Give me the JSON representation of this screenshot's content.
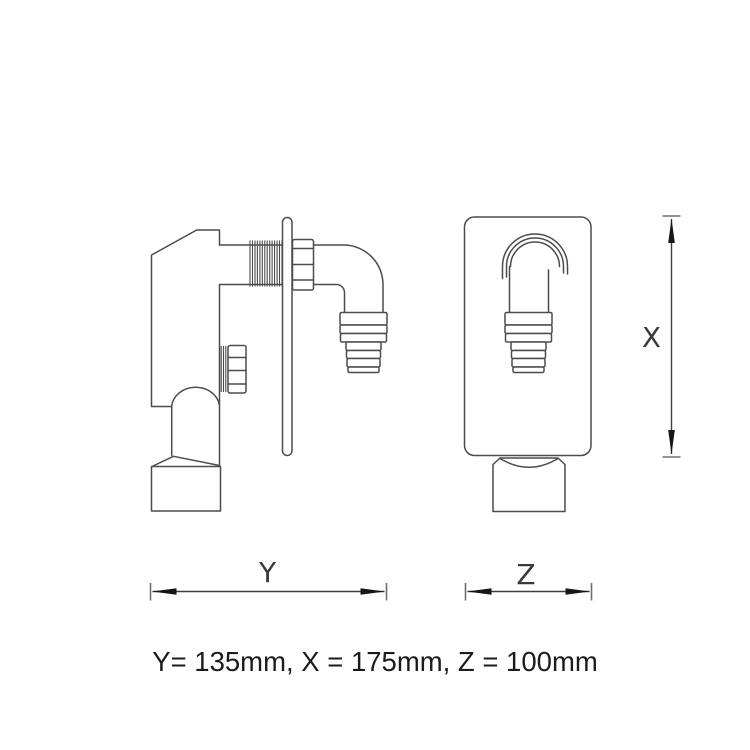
{
  "drawing": {
    "description": "two-view technical line drawing of a through-wall washing machine trap valve",
    "views": [
      {
        "name": "side-view"
      },
      {
        "name": "front-view"
      }
    ]
  },
  "dimensions": {
    "y": {
      "label": "Y",
      "value": 135,
      "unit": "mm"
    },
    "x": {
      "label": "X",
      "value": 175,
      "unit": "mm"
    },
    "z": {
      "label": "Z",
      "value": 100,
      "unit": "mm"
    }
  },
  "caption": {
    "text": "Y= 135mm, X = 175mm, Z = 100mm"
  },
  "colors": {
    "background": "#ffffff",
    "drawing_line": "#4c4c4c",
    "dimension_line": "#3f3f3f",
    "arrowhead": "#161616",
    "caption_text": "#1b1b1b"
  }
}
